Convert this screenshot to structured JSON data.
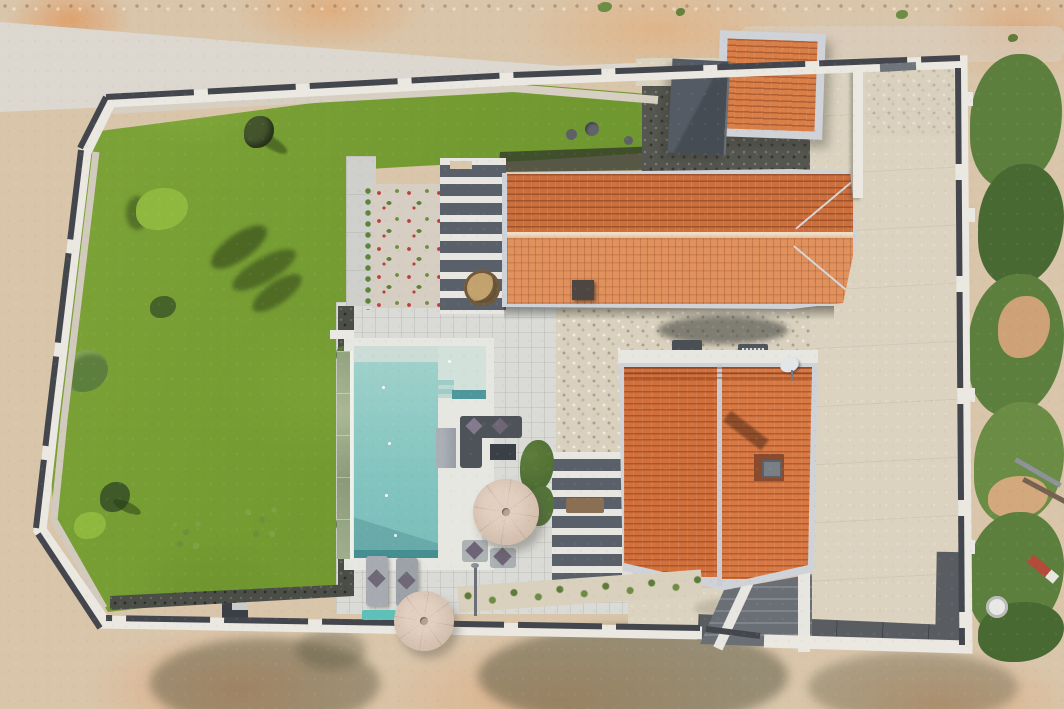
{
  "meta": {
    "type": "aerial-drone-photograph",
    "subject": "Top-down view of a modern walled villa plot with two terracotta gable roofs, flat-roof carport, L-shaped turquoise pool with glass infinity edge, lawn garden, flower bed, pergolas, sun loungers and parasols, gravel driveway, surrounded by bare dirt terrain, a white gravel road on top and wild green vegetation on the right",
    "dimensions": "1064x709"
  },
  "palette": {
    "dirt": "#d9c5aa",
    "dirtOrange": "#dfa478",
    "road": "#dcd7cf",
    "gravelWhite": "#d8d0c2",
    "lawn1": "#7fa63a",
    "lawn2": "#6c9230",
    "lawnDark": "#5a7c25",
    "mulch": "#4b4e47",
    "darkGravel": "#55564f",
    "terrace": "#dadad6",
    "path": "#cfcfcb",
    "flowerGravel": "#d7cec3",
    "flowerRed": "#b9413d",
    "flowerGreen": "#5e7f35",
    "hedge": "#5e8339",
    "poolCoping": "#e7e7e1",
    "poolLedge": "#ccdcd6",
    "poolMain1": "#9ed1ca",
    "poolMain2": "#79bdba",
    "poolDeep": "#3f8b8e",
    "poolStep": "#d3e1db",
    "glass1": "#93a37e",
    "glass2": "#aab795",
    "roofFrame": "#cfd2d6",
    "roofTop": "#cb6f3d",
    "roofBottom": "#e0915c",
    "roofRidge": "#e3bd9c",
    "roofB1": "#d2703c",
    "roofB2": "#d87944",
    "roofSmall": "#d97e47",
    "slate": "#4c525a",
    "wallWhite": "#ebe8e2",
    "wallCap": "#43474d",
    "pebble": "#d9d0bd",
    "drive": "#dbd3bf",
    "asphalt": "#595d62",
    "veg": "#5c7f3e",
    "vegDark": "#486931",
    "vegLight": "#6a8c44",
    "umbrella1": "#e2cfc0",
    "umbrella2": "#c4ad9c",
    "furnGray": "#4d5359",
    "furnLight": "#9aa0a6",
    "cushion": "#837a8e",
    "tealBench": "#5fc0ba",
    "chimney": "#8a4a2e",
    "chimneyCap": "#797f86",
    "concreteEntry": "#6a6f75",
    "white": "#e8e6e0",
    "pergolaBase": "#596069",
    "firePit": "#c2a36e",
    "firePitRing": "#72583c",
    "shadow": "#57563f",
    "treeDark": "#44552e",
    "bushBright": "#8fb83f",
    "treeSparse": "#7ba344"
  },
  "scene": {
    "surroundings": {
      "top": "bare dirt with orange patches and a white gravel road band",
      "right": "wild green shrubs and weeds with building debris, pipes, a white satellite dish and red-white marker",
      "bottom": "bare dirt with tree shadows cast across it",
      "left": "bare dirt"
    },
    "boundary": {
      "description": "white plot wall with dark anthracite capping and white pillars; chamfered corners on the left; sliding-gate opening at bottom center; pedestrian gate in top-right wall",
      "wall_color_ref": "wallWhite",
      "cap_color_ref": "wallCap"
    },
    "garden": {
      "lawn": "large green lawn filling the left half of the plot",
      "trees": [
        "young tree with long shadow (top)",
        "bright green bush",
        "large tree shadow",
        "small bushes",
        "young trees along lower lawn"
      ],
      "flower_bed": "gravel bed with rows of red and green flowers",
      "hedge": "leafy hedge strip on flower-bed left edge",
      "stepping_stones": "three round concrete stones on upper grass strip",
      "utility_box": "small dark utility cabinet at lawn bottom edge"
    },
    "pool_area": {
      "pool": "L-shaped turquoise pool with light tanning ledge, corner steps and dark deep-end edge",
      "infinity_edge": "glass overflow edge with green reflections on the lawn side",
      "deck": "white stone terrace with joint grid",
      "loungers": "two grey sun loungers with dark cushions",
      "teal_bench": "small turquoise bench at pool foot",
      "shower": "outdoor shower pole",
      "umbrellas": "two octagonal beige parasols"
    },
    "buildings": {
      "main_roof_top": "long terracotta gable roof with silver ridge and hipped right end, small dark chimney",
      "main_roof_bottom": "second terracotta gable roof with vertical silver ridge, brick chimney with grey cap, satellite dish, V-shaped lower eave",
      "small_square_roof": "small square terracotta roof with silver frame (street-side annex)",
      "carport": "dark slate flat roof with diagonal seam",
      "pergola_top": "white-beam pergola over dark lounge deck with round rattan fire-pit table",
      "pergola_side": "white-beam pergola over side terrace with wooden bench",
      "ac_units": "two grey AC units and satellite dish on pebble strip between roofs",
      "entrance": "white stair walls and dark concrete steps at bottom gate"
    },
    "ground_surfaces": {
      "driveway": "smooth beige concrete driveway on the right",
      "pebble_strips": "coarse white pebble drainage strips around buildings",
      "dark_gravel": "dark basalt gravel zone around carport and annex",
      "asphalt": "dark grey paved band along inner bottom wall and gate apron"
    },
    "furniture": {
      "lounge_set": "dark grey L-sofa with mauve cushions and low table",
      "outdoor_kitchen": "grey cabinet block",
      "dining": "light table with two diamond-cushion chairs under parasol",
      "plant": "green potted plant between sofa and dining"
    }
  }
}
